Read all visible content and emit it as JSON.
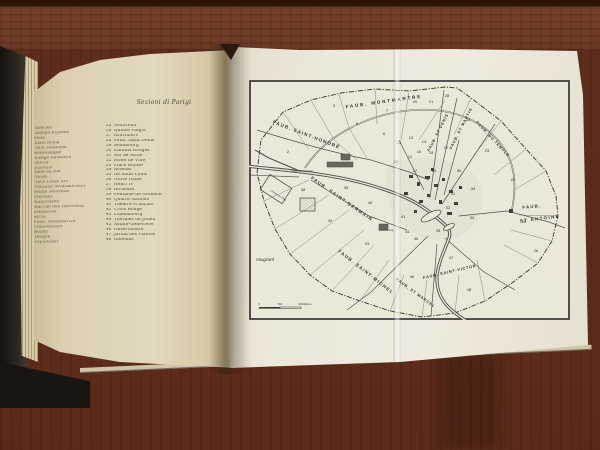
{
  "left_page": {
    "title": "Sezioni di Parigi",
    "sections_1_24": [
      "Tuileries",
      "Champs-Élysées",
      "Roule",
      "Palais Royal",
      "Place Vendôme",
      "Bibliothèque",
      "Grange Batelière",
      "Louvre",
      "Oratoire",
      "Halle au Blé",
      "Postes",
      "Place Louis XIV",
      "Fontaine Montmorency",
      "Bonne Nouvelle",
      "Ponceau",
      "Mauconseil",
      "Marché des Innocents",
      "Lombards",
      "Arcis",
      "Faub. Montmartre",
      "Poissonnière",
      "Bondy",
      "Temple",
      "Popincourt"
    ],
    "sections_25_48": [
      {
        "num": "25",
        "label": "Montreuil"
      },
      {
        "num": "26",
        "label": "Quinze Vingts"
      },
      {
        "num": "27",
        "label": "Gravilliers"
      },
      {
        "num": "28",
        "label": "Faub. Saint-Denis"
      },
      {
        "num": "29",
        "label": "Beaubourg"
      },
      {
        "num": "30",
        "label": "Enfants Rouges"
      },
      {
        "num": "31",
        "label": "Roi de Sicile"
      },
      {
        "num": "32",
        "label": "Hôtel de Ville"
      },
      {
        "num": "33",
        "label": "Place Royale"
      },
      {
        "num": "34",
        "label": "Arsenal"
      },
      {
        "num": "35",
        "label": "Ile Saint-Louis"
      },
      {
        "num": "36",
        "label": "Notre Dame"
      },
      {
        "num": "37",
        "label": "Henri IV"
      },
      {
        "num": "38",
        "label": "Invalides"
      },
      {
        "num": "39",
        "label": "Fontaine de Grenelle"
      },
      {
        "num": "40",
        "label": "Quatre Nations"
      },
      {
        "num": "41",
        "label": "Théâtre Français"
      },
      {
        "num": "42",
        "label": "Croix Rouge"
      },
      {
        "num": "43",
        "label": "Luxembourg"
      },
      {
        "num": "44",
        "label": "Thermes de Julien"
      },
      {
        "num": "45",
        "label": "Sainte-Geneviève"
      },
      {
        "num": "46",
        "label": "Observatoire"
      },
      {
        "num": "47",
        "label": "Jardin des Plantes"
      },
      {
        "num": "48",
        "label": "Gobelins"
      }
    ]
  },
  "map": {
    "area_labels": [
      {
        "text": "FAUB. MONTMARTRE",
        "x": 135,
        "y": 23,
        "rot": -8,
        "size": 4.6,
        "ls": 1.8
      },
      {
        "text": "FAUB. SAINT-HONORÉ",
        "x": 57,
        "y": 56,
        "rot": 21,
        "size": 4.6,
        "ls": 1.2
      },
      {
        "text": "FAUB. ST DENIS",
        "x": 190,
        "y": 53,
        "rot": -63,
        "size": 3.9,
        "ls": 0.8
      },
      {
        "text": "FAUB. ST MARTIN",
        "x": 213,
        "y": 49,
        "rot": -63,
        "size": 3.9,
        "ls": 0.8
      },
      {
        "text": "FAUB. DU TEMPLE",
        "x": 243,
        "y": 60,
        "rot": 47,
        "size": 3.9,
        "ls": 0.8
      },
      {
        "text": "FAUB.",
        "x": 283,
        "y": 128,
        "rot": -6,
        "size": 4.4,
        "ls": 1.2
      },
      {
        "text": "ST ANTOINE",
        "x": 291,
        "y": 140,
        "rot": -7,
        "size": 4.4,
        "ls": 1.4
      },
      {
        "text": "FAUB. SAINT-GERMAIN",
        "x": 92,
        "y": 120,
        "rot": 35,
        "size": 4.6,
        "ls": 1.2
      },
      {
        "text": "FAUB. SAINT-MICHEL",
        "x": 116,
        "y": 193,
        "rot": 38,
        "size": 4.6,
        "ls": 1.2
      },
      {
        "text": "FAUB. ST MARCEL",
        "x": 166,
        "y": 214,
        "rot": 36,
        "size": 3.9,
        "ls": 0.8
      },
      {
        "text": "FAUB. SAINT-VICTOR",
        "x": 201,
        "y": 193,
        "rot": -13,
        "size": 3.9,
        "ls": 0.8
      }
    ],
    "section_numbers": [
      {
        "n": "2",
        "x": 39,
        "y": 73
      },
      {
        "n": "3",
        "x": 85,
        "y": 27
      },
      {
        "n": "5",
        "x": 108,
        "y": 45
      },
      {
        "n": "6",
        "x": 135,
        "y": 55
      },
      {
        "n": "7",
        "x": 138,
        "y": 32
      },
      {
        "n": "11",
        "x": 161,
        "y": 78
      },
      {
        "n": "12",
        "x": 150,
        "y": 64
      },
      {
        "n": "13",
        "x": 162,
        "y": 59
      },
      {
        "n": "14",
        "x": 175,
        "y": 63
      },
      {
        "n": "15",
        "x": 147,
        "y": 83
      },
      {
        "n": "16",
        "x": 170,
        "y": 73
      },
      {
        "n": "17",
        "x": 166,
        "y": 92
      },
      {
        "n": "18",
        "x": 182,
        "y": 74
      },
      {
        "n": "19",
        "x": 185,
        "y": 92
      },
      {
        "n": "20",
        "x": 166,
        "y": 23
      },
      {
        "n": "21",
        "x": 182,
        "y": 23
      },
      {
        "n": "22",
        "x": 219,
        "y": 41
      },
      {
        "n": "23",
        "x": 238,
        "y": 72
      },
      {
        "n": "24",
        "x": 264,
        "y": 101
      },
      {
        "n": "25",
        "x": 275,
        "y": 143
      },
      {
        "n": "26",
        "x": 287,
        "y": 172
      },
      {
        "n": "27",
        "x": 197,
        "y": 69
      },
      {
        "n": "28",
        "x": 198,
        "y": 17
      },
      {
        "n": "30",
        "x": 210,
        "y": 92
      },
      {
        "n": "31",
        "x": 204,
        "y": 115
      },
      {
        "n": "32",
        "x": 199,
        "y": 129
      },
      {
        "n": "33",
        "x": 224,
        "y": 110
      },
      {
        "n": "34",
        "x": 223,
        "y": 139
      },
      {
        "n": "35",
        "x": 189,
        "y": 152
      },
      {
        "n": "38",
        "x": 54,
        "y": 111
      },
      {
        "n": "39",
        "x": 97,
        "y": 109
      },
      {
        "n": "40",
        "x": 121,
        "y": 124
      },
      {
        "n": "41",
        "x": 154,
        "y": 138
      },
      {
        "n": "42",
        "x": 81,
        "y": 142
      },
      {
        "n": "43",
        "x": 118,
        "y": 165
      },
      {
        "n": "44",
        "x": 158,
        "y": 153
      },
      {
        "n": "45",
        "x": 167,
        "y": 160
      },
      {
        "n": "46",
        "x": 163,
        "y": 198
      },
      {
        "n": "47",
        "x": 202,
        "y": 179
      },
      {
        "n": "48",
        "x": 220,
        "y": 211
      }
    ],
    "place_labels": [
      {
        "text": "Vaugirard",
        "x": 7,
        "y": 181,
        "rot": 0,
        "size": 4.2,
        "anchor": "start"
      },
      {
        "text": "Place de Louis XV",
        "x": 53,
        "y": 92,
        "rot": 0,
        "size": 2.6,
        "anchor": "middle"
      },
      {
        "text": "Champ de Mars",
        "x": 29,
        "y": 116,
        "rot": 33,
        "size": 2.6,
        "anchor": "middle"
      },
      {
        "text": "Luxembourg",
        "x": 137,
        "y": 151,
        "rot": 0,
        "size": 2.6,
        "anchor": "middle"
      }
    ],
    "scale": {
      "ticks": [
        "0",
        "500",
        "1000"
      ],
      "unit": "Metres"
    }
  },
  "colors": {
    "wood": "#6d3a25",
    "page_left": "#ddd2b4",
    "map_plate": "#ece8da",
    "ink": "#4f4a39",
    "map_ink": "#37352d",
    "cover": "#181512"
  }
}
